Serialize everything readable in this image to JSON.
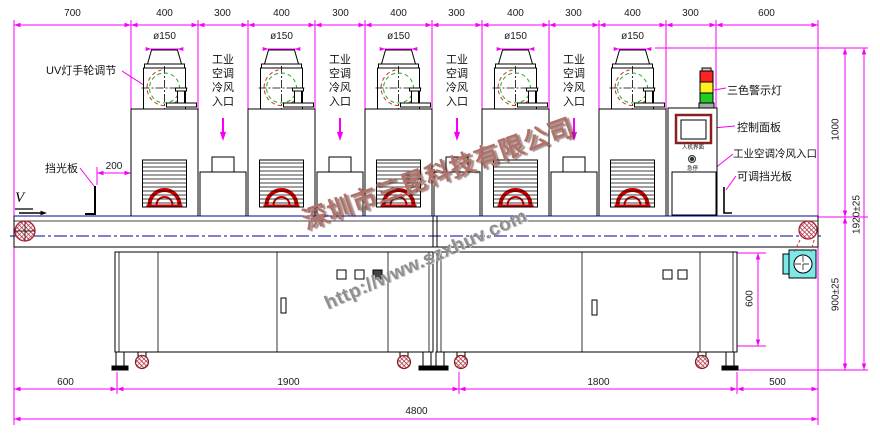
{
  "drawing": {
    "dims_top": [
      "700",
      "400",
      "300",
      "400",
      "300",
      "400",
      "300",
      "400",
      "300",
      "400",
      "300",
      "600"
    ],
    "dims_bottom": {
      "segments": [
        "600",
        "1900",
        "1800",
        "500"
      ],
      "total": "4800"
    },
    "dims_right": {
      "upper": "1000",
      "overall": "1920±25",
      "belt_height": "900±25"
    },
    "dim_cabinet_height": "600",
    "dim_shield_offset": "200",
    "duct_diameter": "ø150",
    "labels": {
      "uv_handwheel": "UV灯手轮调节",
      "light_shield": "挡光板",
      "air_inlet_vertical": "工业\n空调\n冷风\n入口",
      "tricolor_light": "三色警示灯",
      "control_panel": "控制面板",
      "ac_inlet_right": "工业空调冷风入口",
      "adjustable_shield": "可调挡光板",
      "hmi": "人机界面",
      "estop": "急停",
      "direction": "V"
    },
    "watermark": {
      "company": "深圳市三昆科技有限公司",
      "url": "http://www.szxhuv.com"
    },
    "colors": {
      "dimension": "#f800f8",
      "line": "#000000",
      "centerline": "#00009b",
      "red": "#cc0000",
      "red_dash": "#cc3333",
      "green": "#22aa22",
      "warn_red": "#ff2222",
      "warn_yellow": "#ffee22",
      "warn_green": "#22cc22",
      "panel_frame": "#882222",
      "cyan": "#7de8e8",
      "hatch": "#aa2233",
      "text": "#1a1a1a",
      "watermark_company": "#b0736a",
      "watermark_url": "#8f8f8f"
    }
  }
}
